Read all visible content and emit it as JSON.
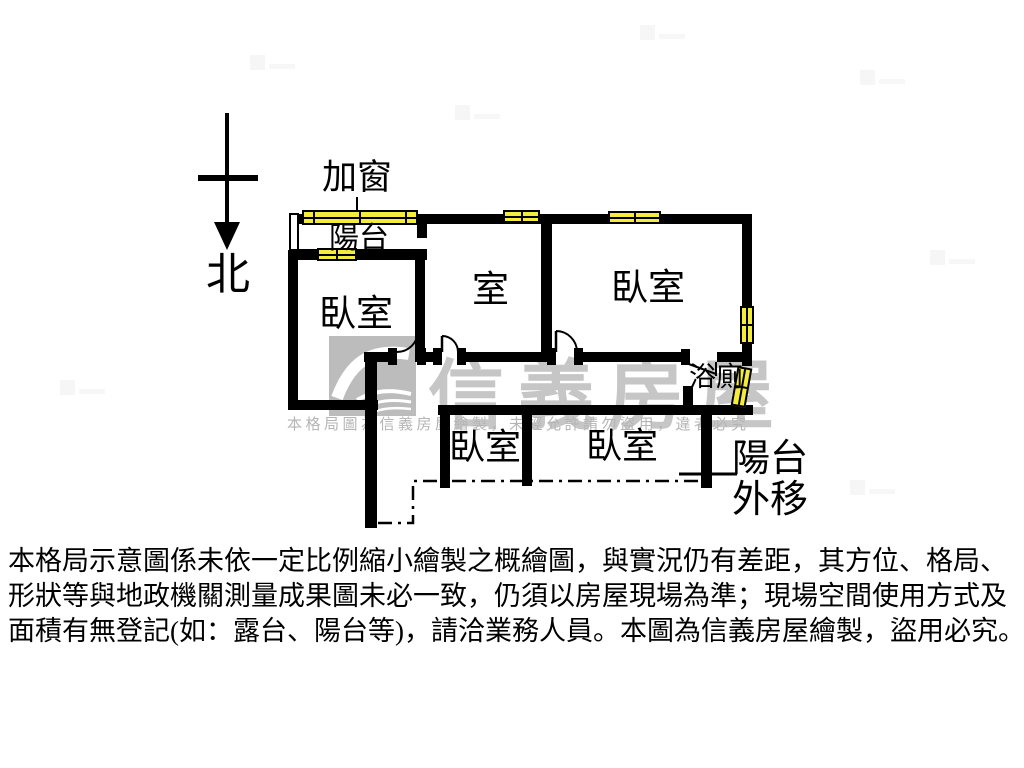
{
  "compass": {
    "north_label": "北"
  },
  "plan": {
    "labels": {
      "add_window": "加窗",
      "balcony": "陽台",
      "bedroom_left": "臥室",
      "middle_room": "室",
      "bedroom_right": "臥室",
      "bathroom": "浴廁",
      "bedroom_lower_left": "臥室",
      "bedroom_lower_right": "臥室",
      "balcony_extended_line1": "陽台",
      "balcony_extended_line2": "外移"
    }
  },
  "watermark": {
    "brand": "信義房屋",
    "notice": "本格局圖為信義房屋繪製，未經允許請勿盜用，違者必究"
  },
  "disclaimer": {
    "line1": "本格局示意圖係未依一定比例縮小繪製之概繪圖，與實況仍有差距，其方位、格局、",
    "line2": "形狀等與地政機關測量成果圖未必一致，仍須以房屋現場為準；現場空間使用方式及",
    "line3": "面積有無登記(如：露台、陽台等)，請洽業務人員。本圖為信義房屋繪製，盜用必究。"
  },
  "colors": {
    "wall": "#000000",
    "window_fill": "#f4ec3d",
    "watermark_text": "#c6c6c6",
    "watermark_notice": "#b5b5b5",
    "logo_bg": "#bcbcbc"
  }
}
